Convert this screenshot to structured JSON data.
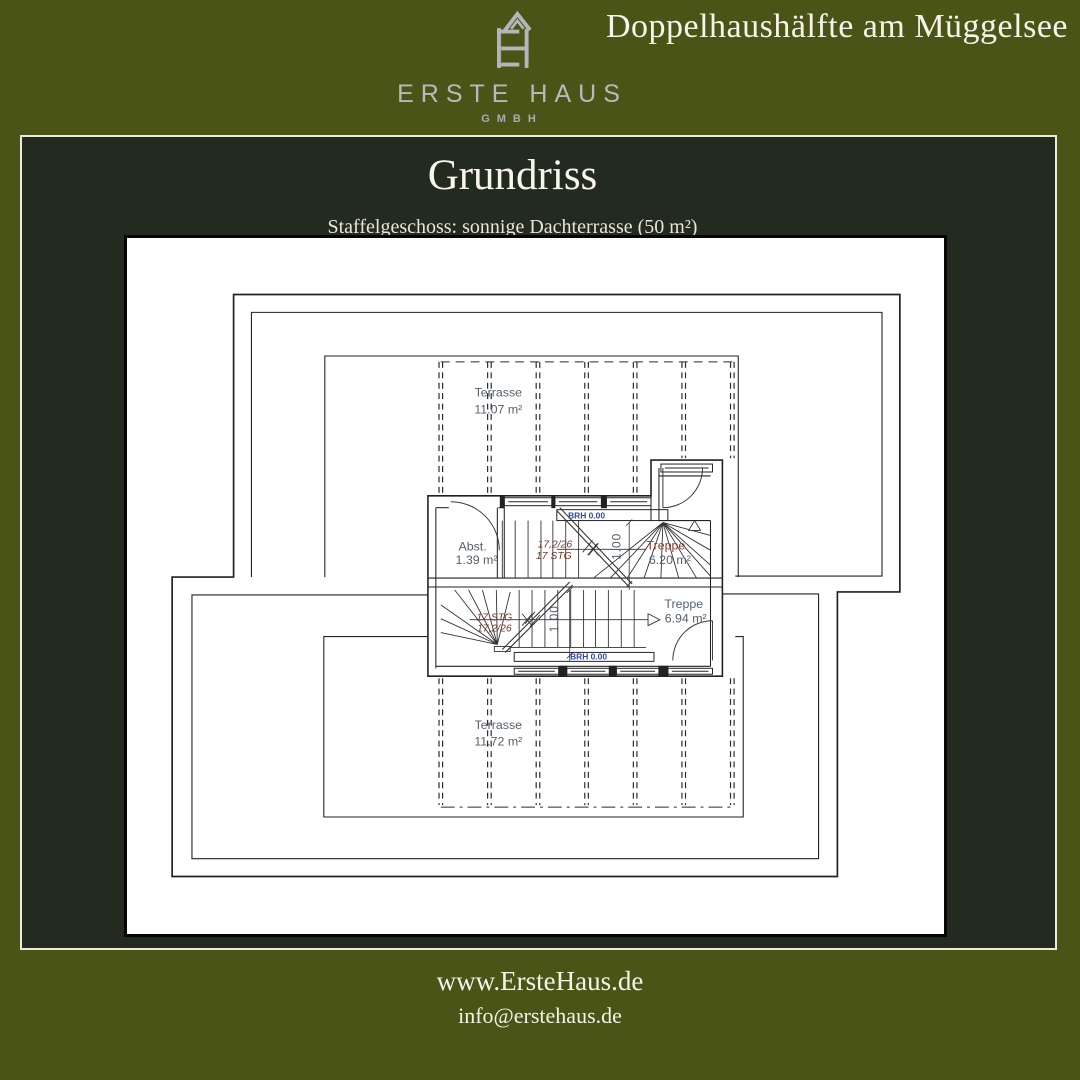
{
  "brand": {
    "name": "ERSTE HAUS",
    "sub": "GMBH",
    "icon": "house-eh-monogram-icon"
  },
  "headline": "Doppelhaushälfte am Müggelsee",
  "panel": {
    "title": "Grundriss",
    "subtitle": "Staffelgeschoss: sonnige Dachterrasse (50 m²)"
  },
  "floorplan": {
    "terrace_top": {
      "label": "Terrasse",
      "area": "11.07 m²"
    },
    "terrace_bottom": {
      "label": "Terrasse",
      "area": "11.72 m²"
    },
    "abstellraum": {
      "label": "Abst.",
      "area": "1.39 m²"
    },
    "stair_top_room": {
      "label": "Treppe",
      "area": "6.20 m²"
    },
    "stair_bottom_room": {
      "label": "Treppe",
      "area": "6.94 m²"
    },
    "stair_top_note": {
      "line1": "17,2/26",
      "line2": "17 STG"
    },
    "stair_bottom_note": {
      "line1": "17 STG",
      "line2": "17,2/26"
    },
    "sill_top": "BRH 0.00",
    "sill_bottom": "BRH 0.00",
    "dim_top": "1.00",
    "dim_bottom": "1.00"
  },
  "footer": {
    "website": "www.ErsteHaus.de",
    "email": "info@erstehaus.de"
  },
  "colors": {
    "background_olive": "#4a5417",
    "panel_dark": "#232a20",
    "panel_border_cream": "#eceadb",
    "plan_line": "#222222",
    "label_slate": "#54616f",
    "label_maroon": "#7a382c",
    "label_blue": "#2d47ad",
    "brand_silver": "#b7babd"
  }
}
